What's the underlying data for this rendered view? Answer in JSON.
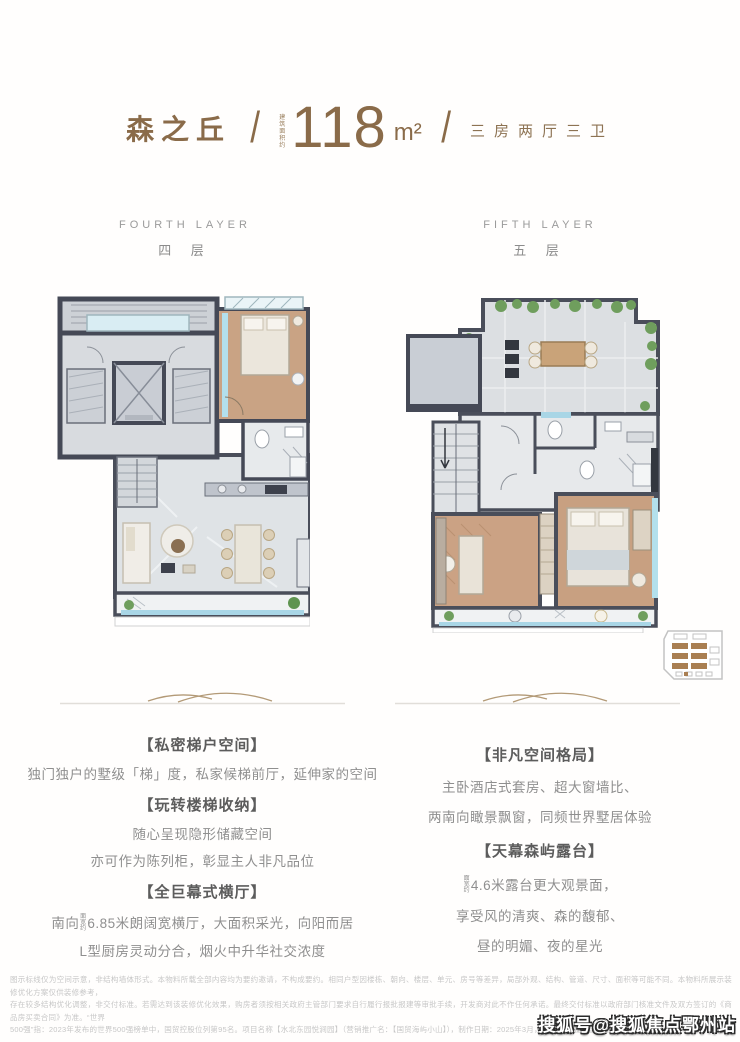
{
  "header": {
    "project_name": "森之丘",
    "slash": "/",
    "area_prefix": "建筑面积约",
    "area_value": "118",
    "area_unit": "m²",
    "layout_tags": "三房两厅三卫"
  },
  "plans": {
    "fourth": {
      "label_en": "FOURTH LAYER",
      "label_cn": "四 层"
    },
    "fifth": {
      "label_en": "FIFTH LAYER",
      "label_cn": "五 层"
    }
  },
  "left_column": {
    "section1_title": "【私密梯户空间】",
    "section1_line1": "独门独户的墅级「梯」度，私家候梯前厅，延伸家的空间",
    "section2_title": "【玩转楼梯收纳】",
    "section2_line1": "随心呈现隐形储藏空间",
    "section2_line2": "亦可作为陈列柜，彰显主人非凡品位",
    "section3_title": "【全巨幕式横厅】",
    "section3_line1_pre": "南向",
    "section3_line1_tiny": "面宽约",
    "section3_line1_rest": "6.85米朗阔宽横厅，大面积采光，向阳而居",
    "section3_line2": "L型厨房灵动分合，烟火中升华社交浓度"
  },
  "right_column": {
    "section1_title": "【非凡空间格局】",
    "section1_line1": "主卧酒店式套房、超大窗墙比、",
    "section1_line2": "两南向瞰景飘窗，同频世界墅居体验",
    "section2_title": "【天幕森屿露台】",
    "section2_line1_tiny": "面宽约",
    "section2_line1_rest": "4.6米露台更大观景面，",
    "section2_line2": "享受风的清爽、森的馥郁、",
    "section2_line3": "昼的明媚、夜的星光"
  },
  "disclaimer": {
    "line1": "图示标线仅为空间示意，非结构墙体形式。本物料所载全部内容均为要约邀请，不构成要约。相同户型因楼栋、朝向、楼层、单元、房号等差异，局部外观、结构、管道、尺寸、面积等可能不同。本物料所展示装修优化方案仅供装修参考，",
    "line2": "存在较多结构优化调整，非交付标准。若需达到该装修优化效果，购房者须按相关政府主管部门要求自行履行报批报建等审批手续，开发商对此不作任何承诺。最终交付标准以政府部门核准文件及双方签订的《商品房买卖合同》为准。“世界",
    "line3": "500强”指：2023年发布的世界500强榜单中，国贸控股位列第95名。项目名称【水北东园悦涧园】（营销推广名：【国贸海屿小山】），制作日期：2025年3月，敬请留意最新宣传物料。"
  },
  "watermark": "搜狐号@搜狐焦点鄂州站",
  "colors": {
    "brand_brown": "#8a6b49",
    "label_grey": "#9a9a9a",
    "body_grey": "#8f8f8f",
    "wall_dark": "#4a4e5a",
    "wood_floor": "#c9a384",
    "glass_blue": "#a9d6e6",
    "plant_green": "#6f9e5d"
  }
}
